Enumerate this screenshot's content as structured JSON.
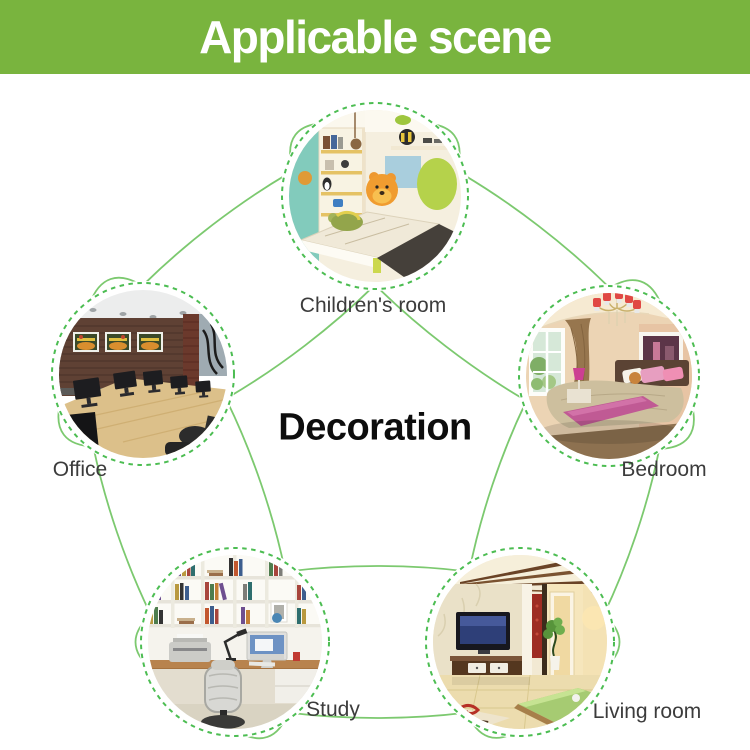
{
  "banner": {
    "title": "Applicable scene"
  },
  "center_label": "Decoration",
  "nodes": [
    {
      "id": "children-room",
      "label": "Children's room"
    },
    {
      "id": "bedroom",
      "label": "Bedroom"
    },
    {
      "id": "living-room",
      "label": "Living room"
    },
    {
      "id": "study",
      "label": "Study"
    },
    {
      "id": "office",
      "label": "Office"
    }
  ],
  "colors": {
    "banner_bg": "#79b43e",
    "banner_text": "#ffffff",
    "orbit_line": "#7cc96f",
    "node_dash": "#4cbd52",
    "label_text": "#3c3c3c",
    "title_text": "#0d0d0d"
  }
}
